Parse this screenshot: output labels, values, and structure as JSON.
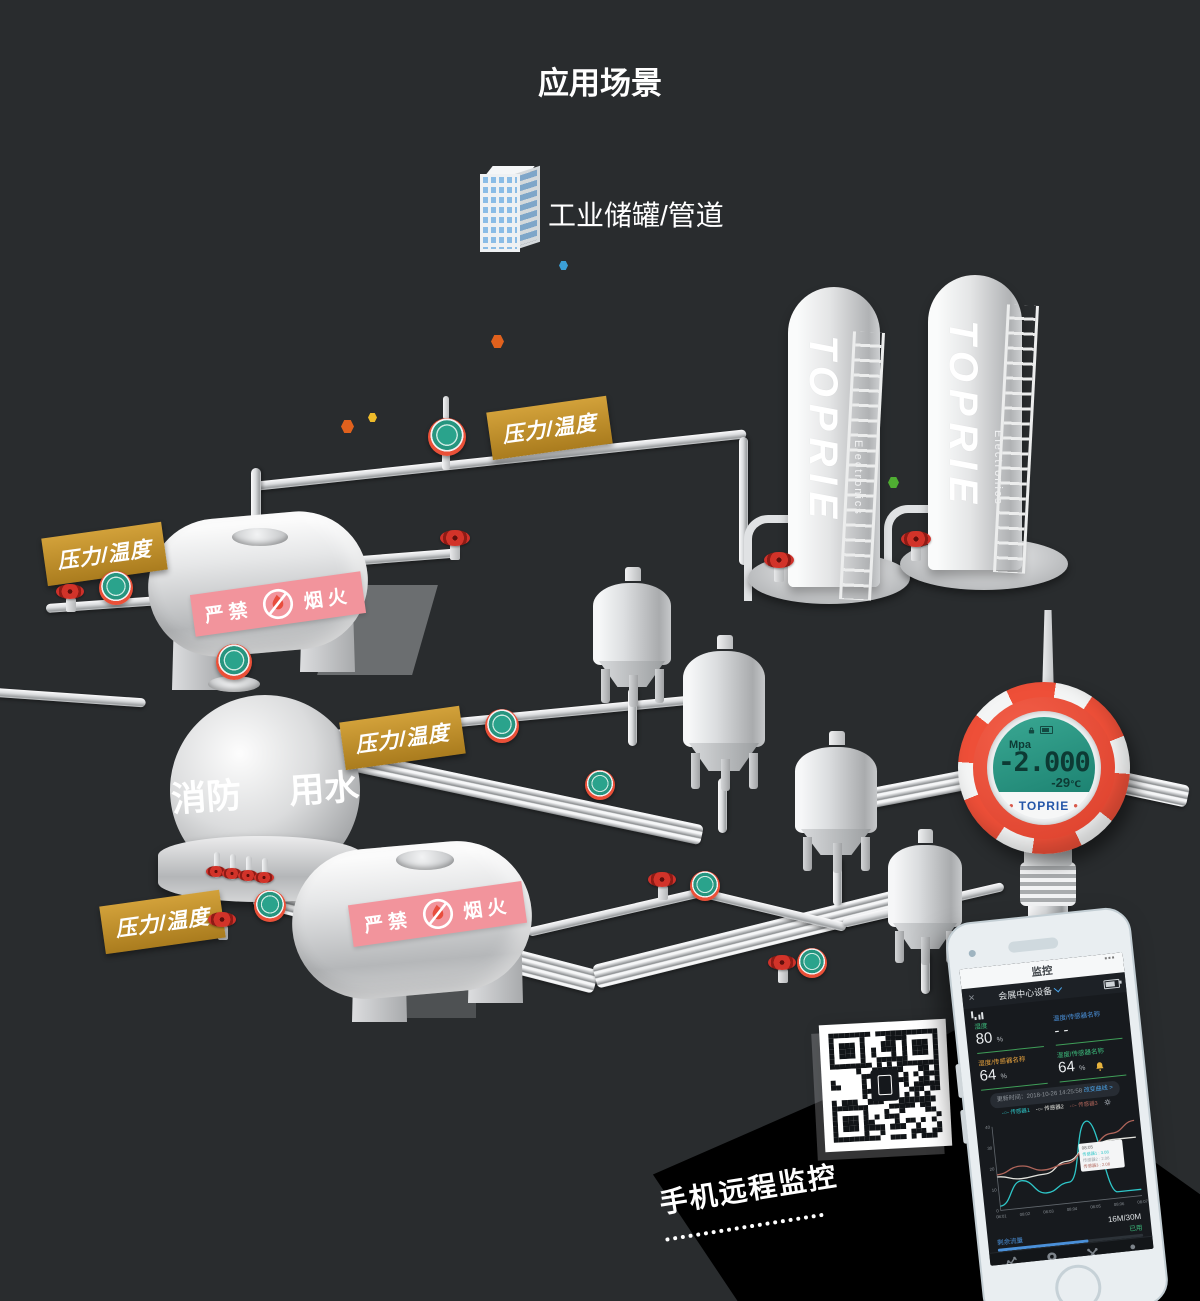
{
  "title": "应用场景",
  "scene": {
    "industry_label": "工业储罐/管道"
  },
  "tag_label": "压力/温度",
  "signs": {
    "no_fire_left": "严禁",
    "no_fire_right": "烟火",
    "sphere_left": "消防",
    "sphere_right": "用水"
  },
  "towers": {
    "brand": "TOPRIE",
    "sub_brand": "Electronics"
  },
  "sensor": {
    "unit": "Mpa",
    "value": "-2.000",
    "temp_value": "-29",
    "temp_unit": "℃",
    "brand": "TOPRIE"
  },
  "remote_caption": "手机远程监控",
  "colors": {
    "accent_gold": "#bf8f2b",
    "sensor_ring": "#ee4f38",
    "lcd_teal": "#2aa38c",
    "band_pink": "#f2949c",
    "phone_blue": "#4aa3e8",
    "phone_green": "#3dbd7d",
    "phone_orange": "#e8a33d"
  },
  "phone": {
    "statusbar": {
      "title": "监控",
      "more": "⋯"
    },
    "header": {
      "close": "×",
      "device": "会展中心设备"
    },
    "metrics": [
      {
        "label": "湿度",
        "value": "80",
        "unit": "%",
        "color": "#3dbd7d",
        "alarm": false
      },
      {
        "label": "温度/传感器名称",
        "value": "- -",
        "unit": "",
        "color": "#4a90d9",
        "alarm": false
      },
      {
        "label": "湿度/传感器名称",
        "value": "64",
        "unit": "%",
        "color": "#e8a33d",
        "alarm": false
      },
      {
        "label": "湿度/传感器名称",
        "value": "64",
        "unit": "%",
        "color": "#3dbd7d",
        "alarm": true
      }
    ],
    "update_time": "更新时间：2018-10-26 14:25:58",
    "change_curve": "改变曲线 >",
    "chart_data": {
      "type": "line",
      "x": [
        "08:01",
        "08:02",
        "08:03",
        "08:04",
        "08:05",
        "08:06",
        "08:07"
      ],
      "ylim": [
        0,
        40
      ],
      "yticks": [
        0,
        10,
        20,
        30,
        40
      ],
      "grid": false,
      "legend_position": "top",
      "series": [
        {
          "name": "传感器1",
          "color": "#2ec7c9",
          "values": [
            2,
            13,
            6,
            10,
            38,
            3,
            3
          ]
        },
        {
          "name": "传感器2",
          "color": "#e3e3dd",
          "values": [
            16,
            14,
            15,
            20,
            26,
            28,
            28
          ]
        },
        {
          "name": "传感器3",
          "color": "#b0655a",
          "values": [
            17,
            20,
            17,
            19,
            26,
            31,
            36
          ]
        }
      ],
      "tooltip": {
        "title": "08:05",
        "rows": [
          "传感器1 : 3.08",
          "传感器2 : 2.08",
          "传感器3 : 2.08"
        ]
      }
    },
    "data_usage": {
      "quota": "16M/30M",
      "used_label": "已用",
      "remain_label": "剩余流量",
      "percent": 62
    },
    "nav": [
      {
        "label": "监控",
        "active": true
      },
      {
        "label": "GIS地图",
        "active": false
      },
      {
        "label": "设备",
        "active": false
      },
      {
        "label": "用户",
        "active": false
      }
    ]
  }
}
